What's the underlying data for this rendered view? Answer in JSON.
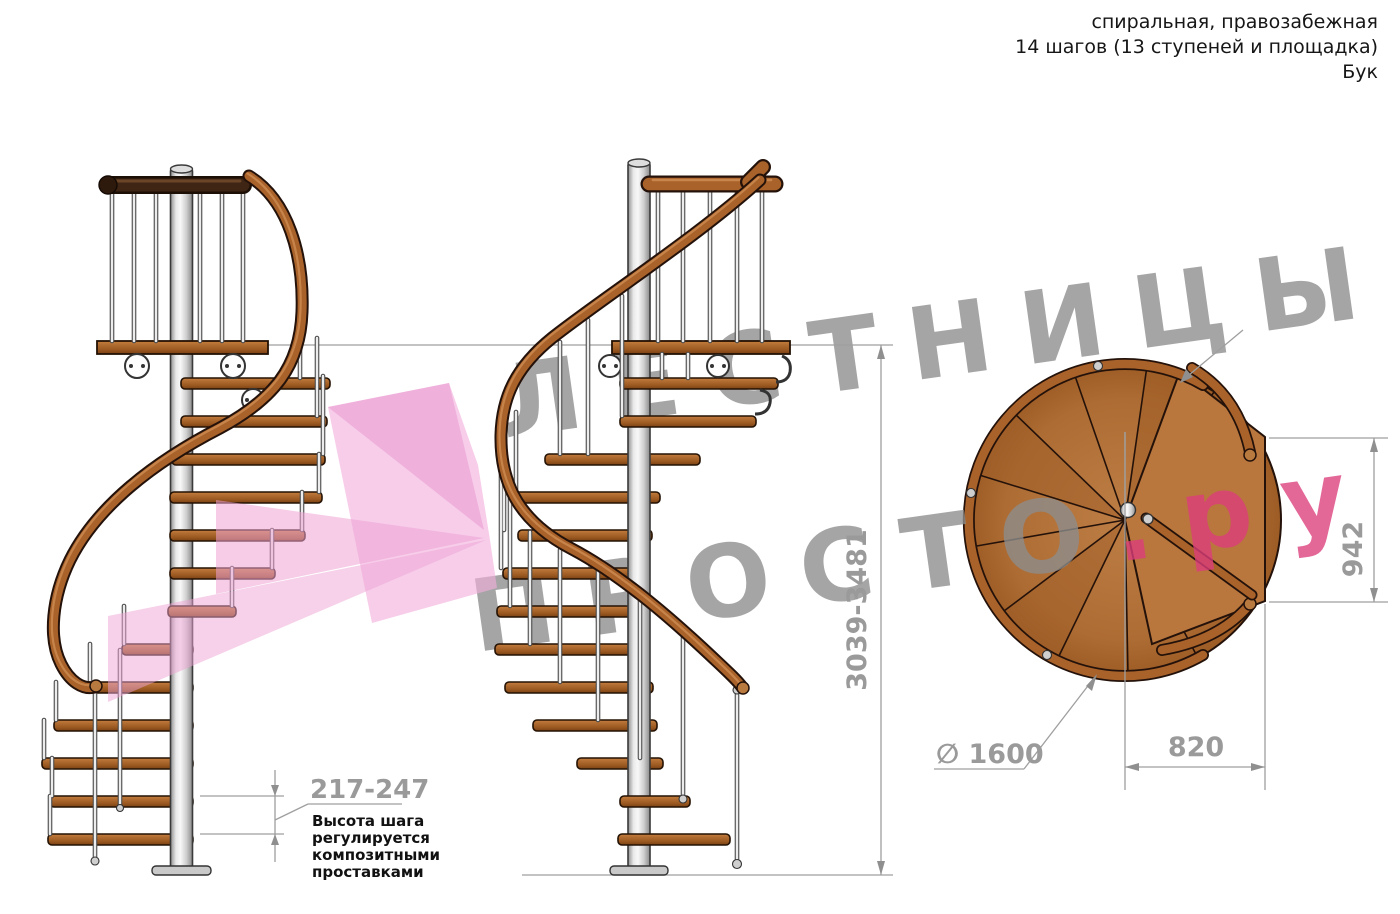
{
  "header": {
    "type_line": "спиральная, правозабежная",
    "steps_line": "14 шагов (13 ступеней и площадка)",
    "material_line": "Бук"
  },
  "watermark": {
    "line1": "ЛЕСТНИЦЫ",
    "line2": "ПРОСТО",
    "line2_suffix": ".ру"
  },
  "dimensions": {
    "total_height": "3039-3481",
    "step_height": "217-247",
    "landing_depth": "942",
    "landing_width": "820",
    "diameter": "∅ 1600"
  },
  "note": {
    "line1": "Высота шага",
    "line2": "регулируется",
    "line3": "композитными",
    "line4": "проставками"
  },
  "colors": {
    "wood": "#a9622a",
    "dark_wood": "#3a2213",
    "metal": "#d9d9d9",
    "dimension_gray": "#9a9a9a",
    "watermark_gray": "#8d8d8d",
    "watermark_pink": "#dc3d7b",
    "arrow_pink": "#f2aedd",
    "text_black": "#161616"
  }
}
